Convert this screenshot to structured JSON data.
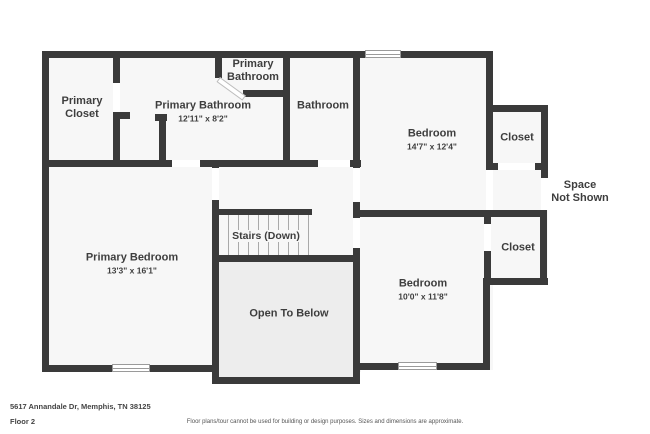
{
  "floorplan": {
    "rooms": {
      "primary_closet": {
        "label": "Primary\nCloset"
      },
      "primary_bathroom_main": {
        "label": "Primary Bathroom",
        "dims": "12'11\" x 8'2\""
      },
      "primary_bathroom_small": {
        "label": "Primary\nBathroom"
      },
      "bathroom": {
        "label": "Bathroom"
      },
      "bedroom_top": {
        "label": "Bedroom",
        "dims": "14'7\" x 12'4\""
      },
      "closet_top": {
        "label": "Closet"
      },
      "space_not_shown": {
        "label": "Space\nNot Shown"
      },
      "closet_bottom": {
        "label": "Closet"
      },
      "bedroom_bottom": {
        "label": "Bedroom",
        "dims": "10'0\" x 11'8\""
      },
      "primary_bedroom": {
        "label": "Primary Bedroom",
        "dims": "13'3\" x 16'1\""
      },
      "stairs": {
        "label": "Stairs (Down)"
      },
      "open_to_below": {
        "label": "Open To Below"
      }
    },
    "colors": {
      "wall": "#3a3a3a",
      "room_fill": "#f7f7f7",
      "open_fill": "#ededed"
    },
    "footer": {
      "address": "5617 Annandale Dr, Memphis, TN 38125",
      "floor": "Floor 2",
      "disclaimer": "Floor plans/tour cannot be used for building or design purposes. Sizes and dimensions are approximate."
    }
  }
}
